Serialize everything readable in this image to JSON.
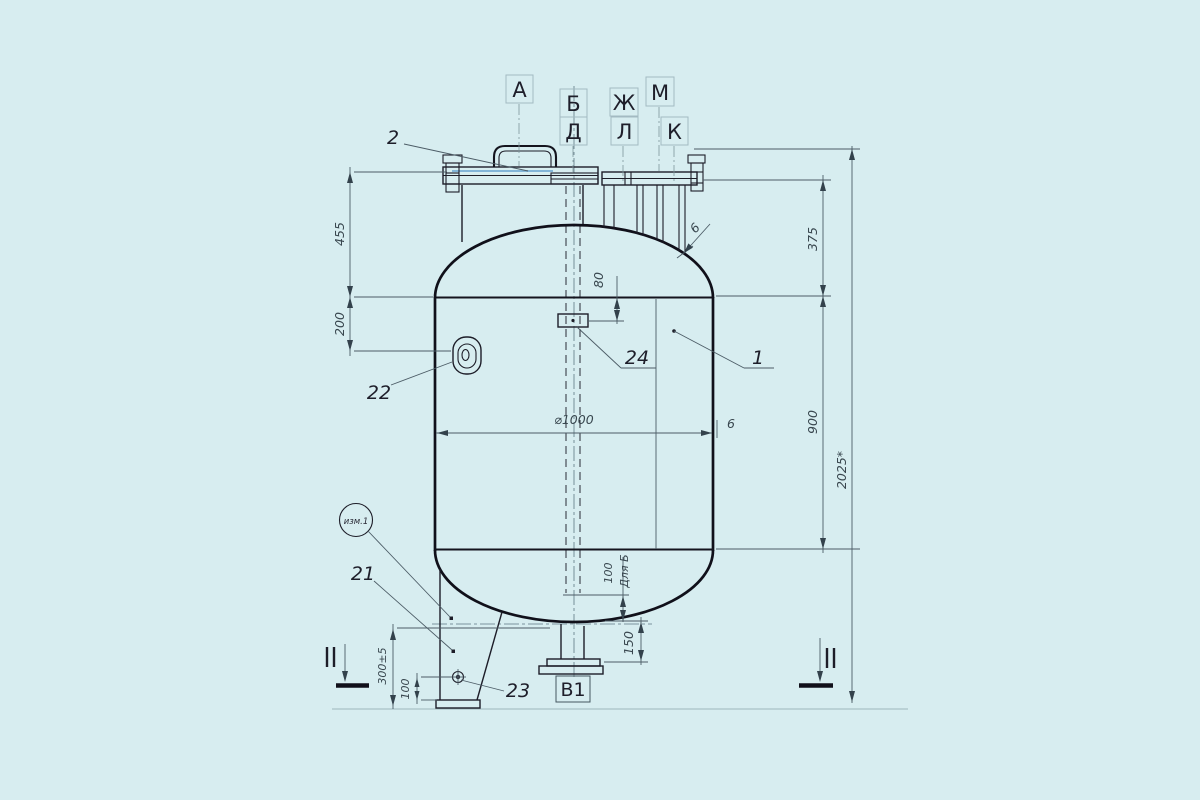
{
  "drawing_type": "vessel-assembly-technical-drawing",
  "colors": {
    "background": "#d7edf0",
    "main_line": "#10101a",
    "dim_line": "#4c5c66",
    "highlight": "#4a90c8"
  },
  "nozzle_labels": {
    "a": "А",
    "b": "Б",
    "d": "Д",
    "zh": "Ж",
    "l": "Л",
    "m": "М",
    "k": "К",
    "v1": "В1"
  },
  "item_callouts": {
    "shell": "1",
    "cover": "2",
    "support": "21",
    "lug": "22",
    "hole": "23",
    "plate": "24"
  },
  "dimensions": {
    "cover_to_tangent": "455",
    "tangent_to_lug": "200",
    "plate_offset": "80",
    "flange_to_tangent_right": "375",
    "shell_height": "900",
    "overall_height": "2025*",
    "diameter": "⌀1000",
    "wall_thickness": "6",
    "head_thickness": "6",
    "pipe_clearance": "100",
    "pipe_clearance_note": "Для Б",
    "bottom_nozzle_height": "150",
    "support_height": "300±5",
    "hole_offset": "100"
  },
  "marks": {
    "revision": "изм.1",
    "section_left": "II",
    "section_right": "II"
  }
}
